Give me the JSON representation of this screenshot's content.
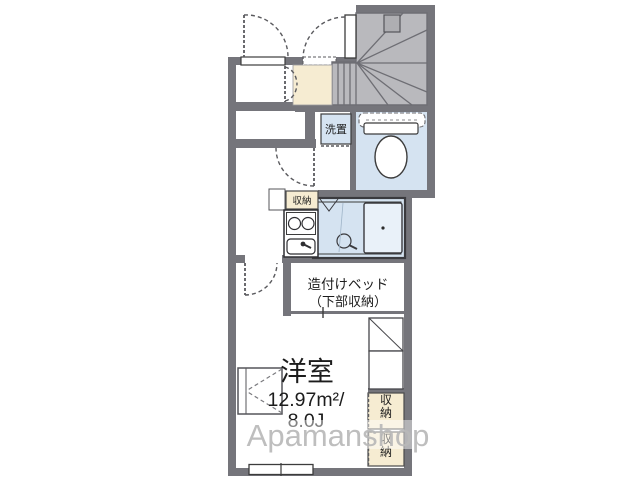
{
  "floorplan": {
    "room": {
      "name_label": "洋室",
      "area_m2_label": "12.97m²/",
      "area_jo_label": "8.0J"
    },
    "bed": {
      "line1": "造付けベッド",
      "line2": "（下部収納）"
    },
    "washer_label": "洗置",
    "kitchen_storage_label": "収納",
    "closet_right_upper_label": "収納",
    "closet_right_lower_label": "収納",
    "watermark": "Apamanshop",
    "colors": {
      "wall": "#75757b",
      "stair_fill": "#b9b9bd",
      "stair_line": "#6e6e74",
      "water_area": "#d5e3f1",
      "tub_fill": "#e9f1f9",
      "tatami_cream": "#f6ecd2",
      "watermark": "#b9b9b9",
      "text": "#1c1c1c"
    },
    "fixtures": [
      "staircase-icon",
      "toilet-icon",
      "overhead-shelf-icon",
      "washing-machine-space",
      "bathtub-icon",
      "drain-icon",
      "stove-icon",
      "sink-icon",
      "refrigerator-space-icon",
      "window-icon",
      "door-swing-arcs"
    ]
  }
}
